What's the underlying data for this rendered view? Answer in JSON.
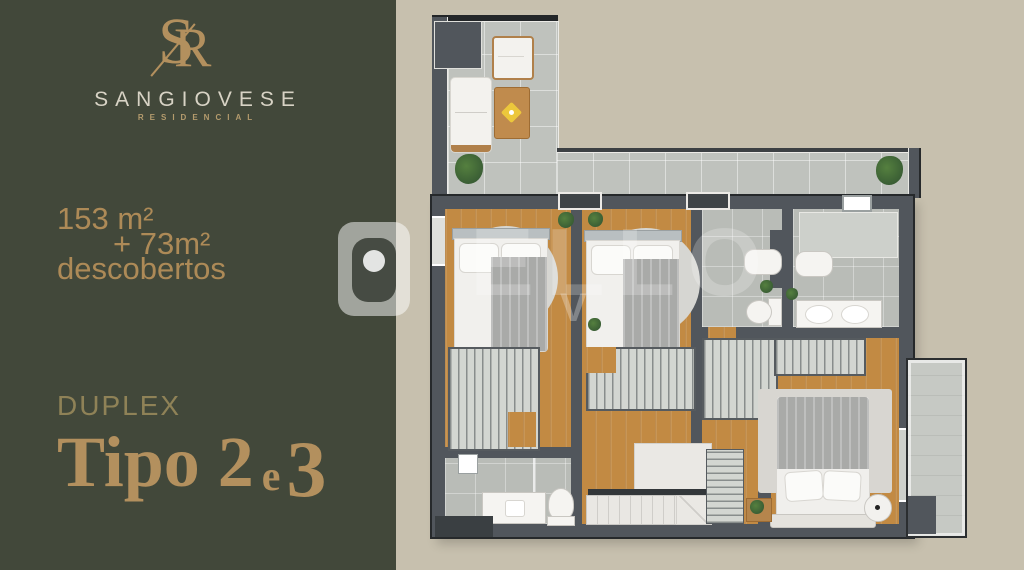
{
  "brand": {
    "monogram_s": "S",
    "monogram_r": "R",
    "name": "SANGIOVESE",
    "tagline": "RESIDENCIAL"
  },
  "area": {
    "line1": "153 m²",
    "line2": "+ 73m²",
    "line3": "descobertos"
  },
  "unit": {
    "label": "DUPLEX",
    "type_word": "Tipo",
    "first_number": "2",
    "conjunction": "e",
    "second_number": "3"
  },
  "watermark": {
    "text": "ELLO",
    "letter": "V"
  },
  "colors": {
    "panel_olive": "#42483a",
    "background_beige": "#c7c0ae",
    "brand_gold": "#b3905e",
    "brand_cream": "#d8d3c5",
    "wall_gray": "#51565c",
    "wood_floor": "#c28a43",
    "tile_gray": "#bfc2bd"
  }
}
